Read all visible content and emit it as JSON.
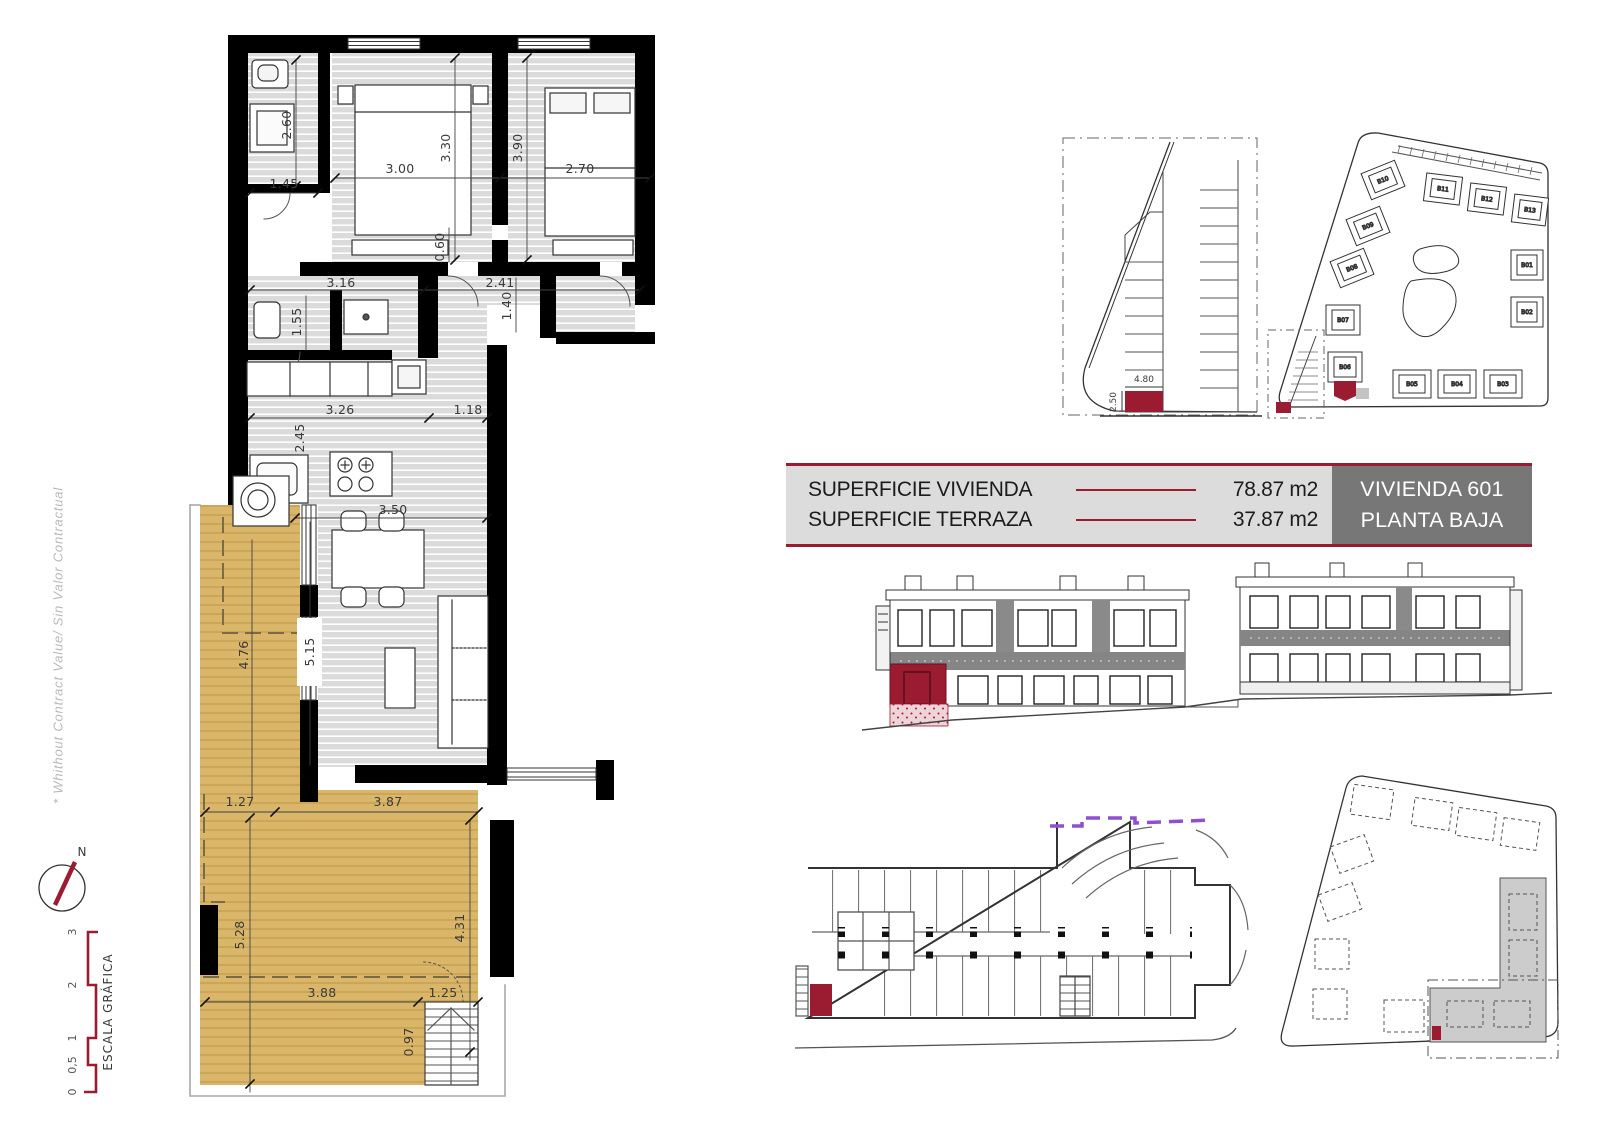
{
  "margin_notes": {
    "disclaimer": "* Whithout Contract Value/ Sin Valor Contractual",
    "compass_n": "N",
    "scale_title": "ESCALA GRÁFICA",
    "scale_ticks": [
      "0",
      "0,5",
      "1",
      "2",
      "3"
    ]
  },
  "info_table": {
    "rows": [
      {
        "label": "SUPERFICIE VIVIENDA",
        "value": "78.87 m2"
      },
      {
        "label": "SUPERFICIE TERRAZA",
        "value": "37.87 m2"
      }
    ],
    "unit_title": "VIVIENDA 601",
    "floor_title": "PLANTA BAJA"
  },
  "colors": {
    "accent": "#9B1B30",
    "terrace": "#D9B66A",
    "floor_stripe": "#DCDCDC",
    "band_gray": "#858585",
    "panel_bg": "#DCDCDC",
    "title_bg": "#777777",
    "purple": "#8E4FD0"
  },
  "floor_plan": {
    "dims": {
      "bath_h": "2.60",
      "bath_w": "1.45",
      "bed1_w": "3.00",
      "bed1_h": "3.30",
      "bed2_w": "2.70",
      "bed2_h": "3.90",
      "wardrobe": "0.60",
      "hall_a": "3.16",
      "hall_b": "2.41",
      "aseo_h": "1.55",
      "pass_h": "1.40",
      "kitchen_a": "3.26",
      "kitchen_b": "1.18",
      "kitchen_h": "2.45",
      "living_w": "3.50",
      "living_h": "5.15",
      "terrace_side": "4.76",
      "ter_a": "1.27",
      "ter_b": "3.87",
      "ter_left": "5.28",
      "ter_right": "4.31",
      "ter_c": "3.88",
      "ter_d": "1.25",
      "ter_e": "0.97"
    }
  },
  "parking_detail": {
    "dims": {
      "width": "4.80",
      "depth": "2.50"
    }
  },
  "site_plan": {
    "buildings": [
      "B10",
      "B11",
      "B12",
      "B13",
      "B09",
      "B08",
      "B07",
      "B06",
      "B05",
      "B04",
      "B03",
      "B02",
      "B01"
    ]
  }
}
